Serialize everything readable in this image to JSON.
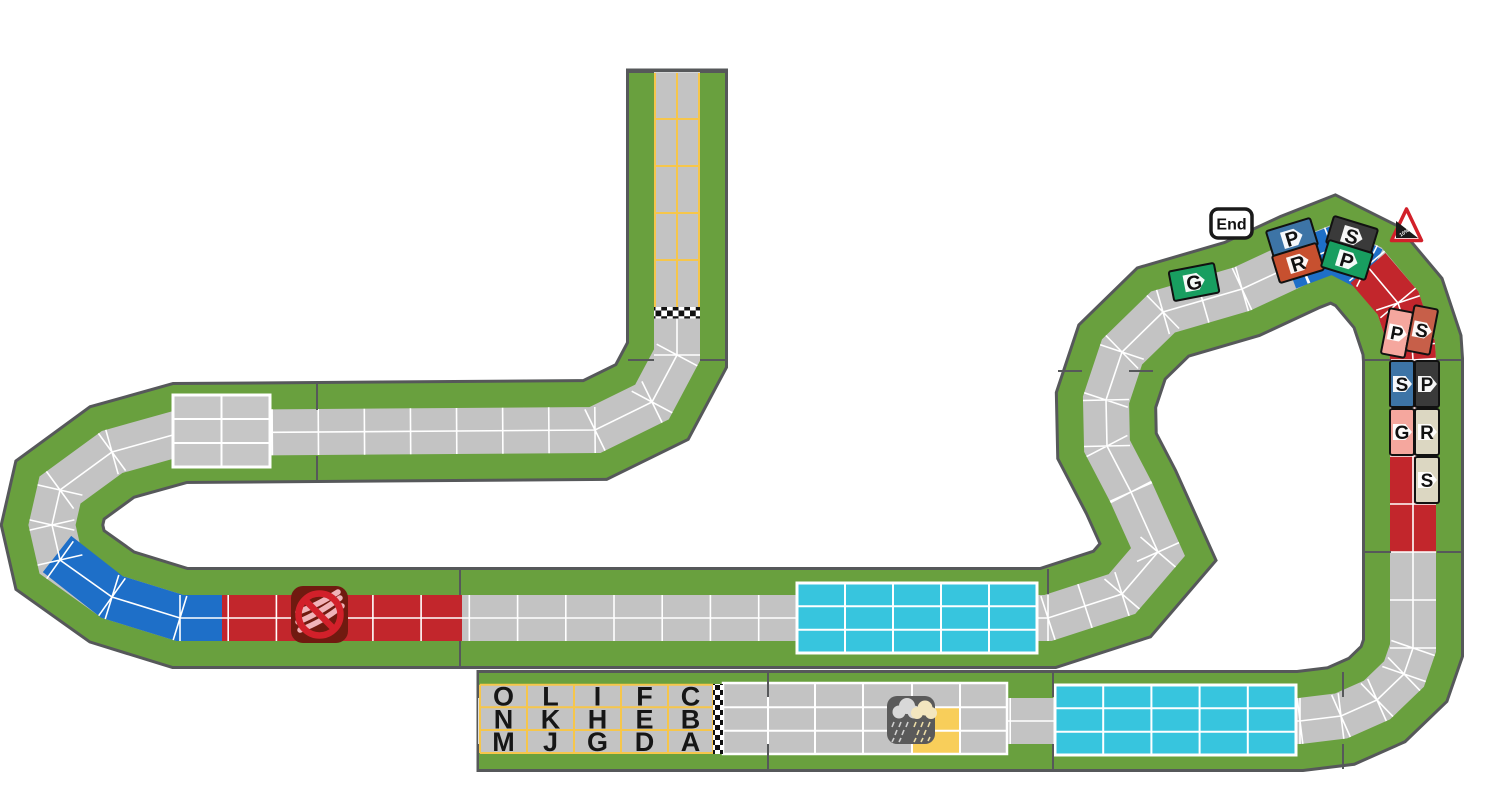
{
  "board": {
    "end_badge_label": "End",
    "warning_sign_label": "10%",
    "start_grid": {
      "rows": [
        [
          "O",
          "L",
          "I",
          "F",
          "C"
        ],
        [
          "N",
          "K",
          "H",
          "E",
          "B"
        ],
        [
          "M",
          "J",
          "G",
          "D",
          "A"
        ]
      ]
    },
    "riders": [
      {
        "letter": "P",
        "bg": "#3D74A6",
        "team_color": "blue",
        "area": "summit-left-outer"
      },
      {
        "letter": "R",
        "bg": "#C7502F",
        "team_color": "orange-red",
        "area": "summit-left-inner"
      },
      {
        "letter": "S",
        "bg": "#3A3A3A",
        "team_color": "black",
        "area": "summit-right-outer"
      },
      {
        "letter": "P",
        "bg": "#189E60",
        "team_color": "green",
        "area": "summit-right-inner"
      },
      {
        "letter": "P",
        "bg": "#F5A79E",
        "team_color": "pink",
        "area": "descent-curve-outer"
      },
      {
        "letter": "S",
        "bg": "#C75F49",
        "team_color": "salmon",
        "area": "descent-curve-inner"
      },
      {
        "letter": "S",
        "bg": "#3D74A6",
        "team_color": "blue",
        "area": "descent-column-row1-left"
      },
      {
        "letter": "P",
        "bg": "#3A3A3A",
        "team_color": "black",
        "area": "descent-column-row1-right"
      },
      {
        "letter": "G",
        "bg": "#F5A79E",
        "team_color": "pink",
        "area": "descent-column-row2-left"
      },
      {
        "letter": "R",
        "bg": "#DCD7C2",
        "team_color": "cream",
        "area": "descent-column-row2-right"
      },
      {
        "letter": "S",
        "bg": "#DCD7C2",
        "team_color": "cream",
        "area": "descent-column-row3-right"
      },
      {
        "letter": "G",
        "bg": "#189E60",
        "team_color": "green",
        "area": "before-end-diagonal"
      }
    ],
    "icons": {
      "weather": "rain-clouds",
      "no_drafting": "crossed-out-slipstream",
      "steep_descent": "warning-triangle-grade"
    },
    "colors": {
      "grass": "#69A03E",
      "road": "#C3C3C3",
      "border": "#56585A",
      "lane": "#FFFFFF",
      "section_blue": "#1E6FC8",
      "section_red": "#C2262C",
      "section_cyan": "#37C5DE",
      "grid_yellow": "#F6C64B",
      "weather_cell": "#F8CE5A"
    }
  }
}
